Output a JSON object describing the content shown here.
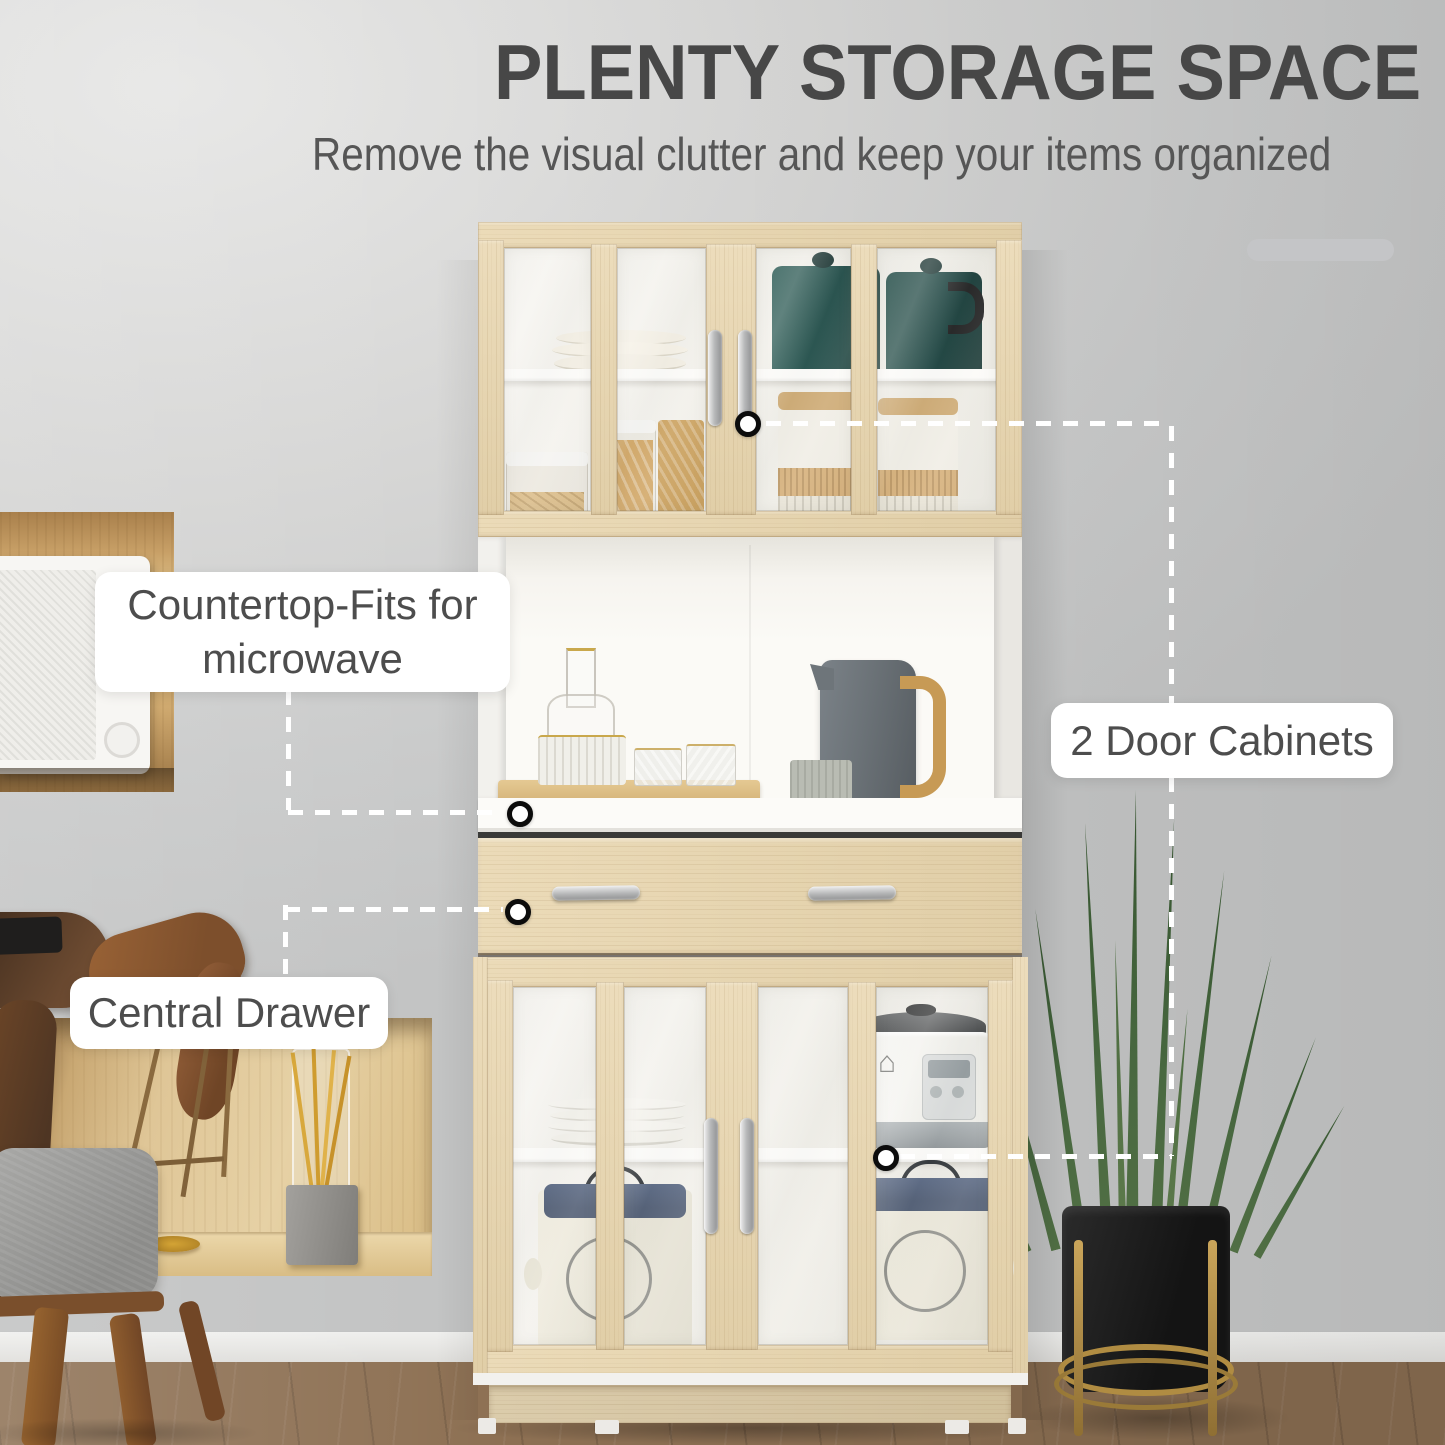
{
  "header": {
    "title": "PLENTY STORAGE SPACE",
    "subtitle": "Remove the visual clutter and keep your items organized"
  },
  "callouts": {
    "countertop": {
      "line1": "Countertop-Fits for",
      "line2": "microwave"
    },
    "door_cabinets": {
      "label": "2 Door Cabinets"
    },
    "central_drawer": {
      "label": "Central Drawer"
    }
  },
  "colors": {
    "title": "#474747",
    "subtitle": "#565656",
    "labeltext": "#4d4d4d",
    "dash": "#ffffff",
    "wood": "#e8d5ad",
    "white": "#fbfaf7",
    "floor": "#8d7053",
    "plant": "#42613c",
    "pot": "#1b1b1b",
    "gold": "#b08c42",
    "teal": "#16433e",
    "lidblue": "#46536b",
    "kettle": "#6b7277"
  }
}
